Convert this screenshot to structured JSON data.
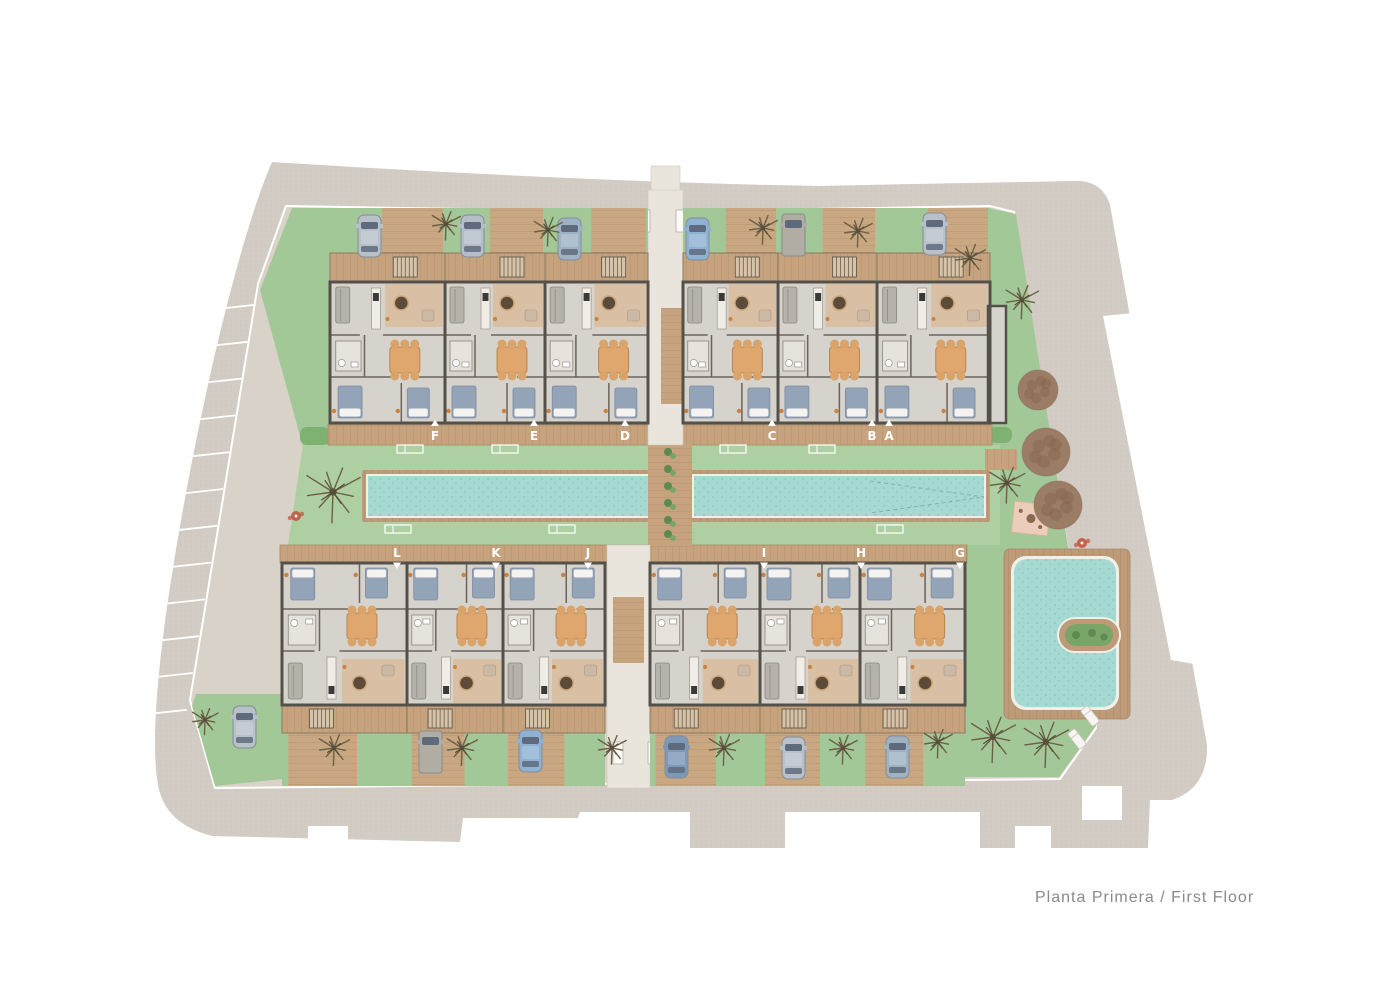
{
  "title": {
    "text": "Planta Primera / First Floor"
  },
  "plan": {
    "colors": {
      "page": "#ffffff",
      "road": "#d3ccc4",
      "inner": "#d9d2c9",
      "pavement": "#e9e5dd",
      "boundary": "#ffffff",
      "lawn": "#a3c897",
      "lawn_light": "#aecfa2",
      "lawn_dark": "#7fb173",
      "water": "#a5d9d1",
      "water_dot": "#8fccc3",
      "pool_rim": "#bd9a78",
      "pool_edge": "#f0efe8",
      "wood": "#c7a37d",
      "wood_dark": "#a88a68",
      "wood_drive": "#c9a780",
      "wood_line": "#7a5f45",
      "wall": "#54504a",
      "floor": "#d6d3cc",
      "partition": "#6a645c",
      "bed": "#93a3b8",
      "pillow": "#f4f3ef",
      "table": "#dfa76e",
      "chair": "#d9a369",
      "sofa": "#b5b2aa",
      "coffee": "#5d4a39",
      "coffee_ring": "#caa87c",
      "accent": "#c98242",
      "bath": "#e6e3dd",
      "kitchen": "#f0ede7",
      "living_wood": "#d9bfa2",
      "patio": "#eccdb9",
      "canopy": "#9b7d65",
      "canopy_dark": "#85664f",
      "palm": "#6d6046",
      "palm_dark": "#55503c",
      "shrub": "#5e8a52",
      "shrub_light": "#7aa568",
      "label": "#ffffff",
      "title": "#8a8a8a",
      "red": "#c14f3a",
      "car_window": "#5f6b7c",
      "car_stroke": "#848c98"
    },
    "rows": {
      "top": {
        "terrace_y": 253,
        "terrace_h": 29,
        "interior_y": 282,
        "interior_h": 141,
        "walk_y": 425,
        "walk_h": 20,
        "drive_y": 208,
        "drive_h": 45,
        "arrow": "up"
      },
      "bottom": {
        "terrace_y": 705,
        "terrace_h": 28,
        "interior_y": 563,
        "interior_h": 142,
        "walk_y": 545,
        "walk_h": 18,
        "drive_y": 733,
        "drive_h": 53,
        "arrow": "down"
      }
    },
    "units": [
      {
        "id": "F",
        "row": "top",
        "x": 330,
        "w": 115,
        "label_x": 435
      },
      {
        "id": "E",
        "row": "top",
        "x": 445,
        "w": 100,
        "label_x": 534
      },
      {
        "id": "D",
        "row": "top",
        "x": 545,
        "w": 103,
        "label_x": 625
      },
      {
        "id": "C",
        "row": "top",
        "x": 683,
        "w": 95,
        "label_x": 772
      },
      {
        "id": "B",
        "row": "top",
        "x": 778,
        "w": 99,
        "label_x": 872
      },
      {
        "id": "A",
        "row": "top",
        "x": 877,
        "w": 113,
        "label_x": 889,
        "annex": {
          "x": 988,
          "y": 306,
          "w": 18,
          "h": 117
        }
      },
      {
        "id": "L",
        "row": "bottom",
        "x": 282,
        "w": 125,
        "label_x": 397
      },
      {
        "id": "K",
        "row": "bottom",
        "x": 407,
        "w": 96,
        "label_x": 496
      },
      {
        "id": "J",
        "row": "bottom",
        "x": 503,
        "w": 102,
        "label_x": 588
      },
      {
        "id": "I",
        "row": "bottom",
        "x": 650,
        "w": 110,
        "label_x": 764
      },
      {
        "id": "H",
        "row": "bottom",
        "x": 760,
        "w": 100,
        "label_x": 861
      },
      {
        "id": "G",
        "row": "bottom",
        "x": 860,
        "w": 105,
        "label_x": 960
      }
    ],
    "cars": [
      {
        "x": 358,
        "y": 215,
        "type": "car",
        "color": "#b8c0ca"
      },
      {
        "x": 461,
        "y": 215,
        "type": "car",
        "color": "#b4bdc8"
      },
      {
        "x": 558,
        "y": 218,
        "type": "car",
        "color": "#9fb2c4"
      },
      {
        "x": 686,
        "y": 218,
        "type": "car",
        "color": "#8fb2d4"
      },
      {
        "x": 782,
        "y": 214,
        "type": "van",
        "color": "#b2ada3"
      },
      {
        "x": 923,
        "y": 213,
        "type": "car",
        "color": "#b8c0ca"
      },
      {
        "x": 233,
        "y": 706,
        "type": "car",
        "color": "#b8c0ca"
      },
      {
        "x": 419,
        "y": 731,
        "type": "van",
        "color": "#b2ada3"
      },
      {
        "x": 519,
        "y": 730,
        "type": "car",
        "color": "#8fb2d4"
      },
      {
        "x": 665,
        "y": 736,
        "type": "car",
        "color": "#7e99b8"
      },
      {
        "x": 782,
        "y": 737,
        "type": "car",
        "color": "#b8c0ca"
      },
      {
        "x": 886,
        "y": 736,
        "type": "car",
        "color": "#9fb2c4"
      }
    ],
    "palms": [
      [
        205,
        720,
        1.1
      ],
      [
        333,
        492,
        2.3
      ],
      [
        446,
        224,
        1.2
      ],
      [
        548,
        230,
        1.2
      ],
      [
        763,
        228,
        1.2
      ],
      [
        858,
        231,
        1.2
      ],
      [
        970,
        258,
        1.3
      ],
      [
        1022,
        300,
        1.4
      ],
      [
        1007,
        483,
        1.5
      ],
      [
        334,
        748,
        1.3
      ],
      [
        462,
        748,
        1.3
      ],
      [
        612,
        748,
        1.2
      ],
      [
        724,
        748,
        1.3
      ],
      [
        843,
        748,
        1.2
      ],
      [
        938,
        742,
        1.2
      ],
      [
        993,
        737,
        1.9
      ],
      [
        1046,
        742,
        1.9
      ]
    ],
    "canopies": [
      [
        1038,
        390,
        20
      ],
      [
        1046,
        452,
        24
      ],
      [
        1058,
        505,
        24
      ]
    ],
    "loungers": [
      [
        1090,
        716
      ],
      [
        1077,
        739
      ]
    ],
    "sunbeds": [
      [
        410,
        449
      ],
      [
        505,
        449
      ],
      [
        733,
        449
      ],
      [
        822,
        449
      ],
      [
        398,
        529
      ],
      [
        562,
        529
      ],
      [
        890,
        529
      ]
    ],
    "shrub_column": {
      "x": 670,
      "ys": [
        452,
        469,
        486,
        503,
        520,
        534
      ]
    },
    "parking": {
      "count": 12,
      "y0": 305,
      "dy": 36.8
    },
    "pools": {
      "left": {
        "x": 368,
        "y": 476,
        "w": 280,
        "h": 40
      },
      "right": {
        "x": 694,
        "y": 476,
        "w": 290,
        "h": 40
      },
      "garden": {
        "deck": [
          1004,
          549,
          126,
          170
        ],
        "water": [
          1014,
          559,
          102,
          148
        ],
        "planter": [
          1058,
          618,
          62,
          34
        ]
      }
    },
    "dark_patches": [
      [
        300,
        427,
        30,
        18
      ],
      [
        318,
        545,
        70,
        15
      ],
      [
        938,
        545,
        26,
        15
      ],
      [
        988,
        427,
        24,
        16
      ]
    ],
    "patio": {
      "x": 1013,
      "y": 503,
      "w": 36,
      "h": 31
    },
    "bistros": [
      [
        1082,
        543
      ],
      [
        296,
        516
      ]
    ],
    "posts": [
      [
        640,
        210
      ],
      [
        676,
        210
      ],
      [
        613,
        742
      ],
      [
        648,
        742
      ]
    ],
    "wood_platform": [
      985,
      449,
      32,
      21
    ]
  }
}
